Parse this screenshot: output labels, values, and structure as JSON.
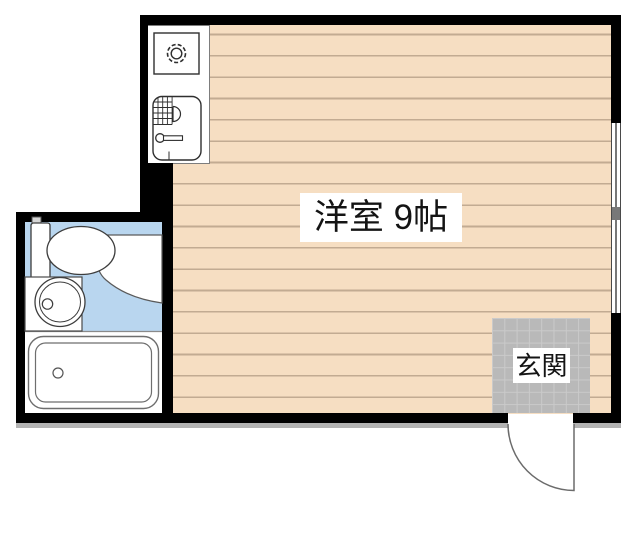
{
  "plan": {
    "labels": {
      "main_room": "洋室 9帖",
      "entrance": "玄関"
    },
    "rooms": [
      {
        "name": "western-room",
        "label": "洋室 9帖",
        "floor": "wood"
      },
      {
        "name": "entrance",
        "label": "玄関",
        "floor": "tile"
      },
      {
        "name": "bathroom",
        "label": "",
        "floor": "tile"
      },
      {
        "name": "kitchen",
        "label": "",
        "floor": "none"
      }
    ],
    "fixtures": [
      "stove-burner",
      "kitchen-sink",
      "toilet",
      "wash-basin",
      "vanity-counter",
      "bathtub",
      "sliding-window",
      "entry-door"
    ],
    "colors": {
      "background": "#ffffff",
      "wall": "#000000",
      "floor": "#f6dec2",
      "floor_line": "#c2ab92",
      "bath_tile": "#b9d6ef",
      "genkan_tile": "#b9b9b9",
      "genkan_grid": "#cacaca",
      "fixture_outline": "#3d3d3d",
      "shadow": "#b3b3b3"
    }
  }
}
